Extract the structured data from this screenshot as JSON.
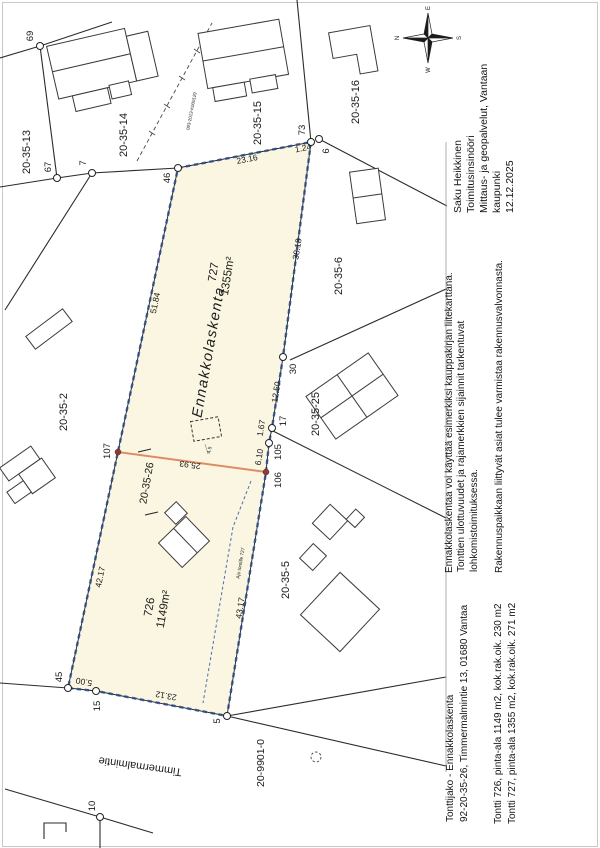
{
  "document": {
    "title_block": {
      "surveyor_name": "Saku Heikkinen",
      "surveyor_title": "Toimitusinsinööri",
      "surveyor_org_line1": "Mittaus- ja geopalvelut, Vantaan",
      "surveyor_org_line2": "kaupunki",
      "date": "12.12.2025"
    },
    "notes": {
      "note1": "Ennakkolaskentaa voi käyttää esimerkiksi kauppakirjan liitekarttana.",
      "note2_line1": "Tonttien ulottuvuudet ja rajamerkkien sijainnit tarkentuvat",
      "note2_line2": "lohkomistoimituksessa.",
      "note3": "Rakennuspaikkaan liittyvät asiat tulee varmistaa rakennusvalvonnasta."
    },
    "footer": {
      "doc_type": "Tonttijako - Ennakkolaskenta",
      "property": "92-20-35-26, Timmermalmintie 13, 01680 Vantaa",
      "plot1_info": "Tontti 726, pinta-ala 1149 m2, kok.rak.oik. 230 m2",
      "plot2_info": "Tontti 727, pinta-ala 1355 m2, kok.rak.oik. 271 m2"
    }
  },
  "compass": {
    "n": "N",
    "e": "E",
    "s": "S",
    "w": "W"
  },
  "map": {
    "parcels": {
      "plot727_number": "727",
      "plot727_area": "1355m²",
      "plot726_number": "726",
      "plot726_area": "1149m²",
      "parent_id": "20-35-26",
      "watermark": "Ennakkolaskenta"
    },
    "neighbors": {
      "n13": "20-35-13",
      "n14": "20-35-14",
      "n15": "20-35-15",
      "n16": "20-35-16",
      "n6": "20-35-6",
      "n25": "20-35-25",
      "n5": "20-35-5",
      "n2": "20-35-2"
    },
    "street_name": "Timmermalmintie",
    "road_parcel": "20-9901-0",
    "survey_ref": "093-2013-K000129",
    "driveway_note": "Ajo tontille 727",
    "setback": "4.5",
    "points": {
      "p69": "69",
      "p67": "67",
      "p7": "7",
      "p46": "46",
      "p73": "73",
      "p6": "6",
      "p30": "30",
      "p17": "17",
      "p105": "105",
      "p106": "106",
      "p107": "107",
      "p45": "45",
      "p15": "15",
      "p5": "5",
      "p10": "10"
    },
    "dims": {
      "d2316": "23.16",
      "d124": "1.24",
      "d5184": "51.84",
      "d3818": "38.18",
      "d1250": "12.50",
      "d167": "1.67",
      "d610": "6.10",
      "d2593": "25.93",
      "d4217": "42.17",
      "d4317": "43.17",
      "d2312": "23.12",
      "d500": "5.00"
    },
    "colors": {
      "parcel_fill": "#faf6e2",
      "boundary_blue": "#2a4a8a",
      "new_boundary_orange": "#e08b63",
      "marker_red": "#8d3b35"
    }
  }
}
